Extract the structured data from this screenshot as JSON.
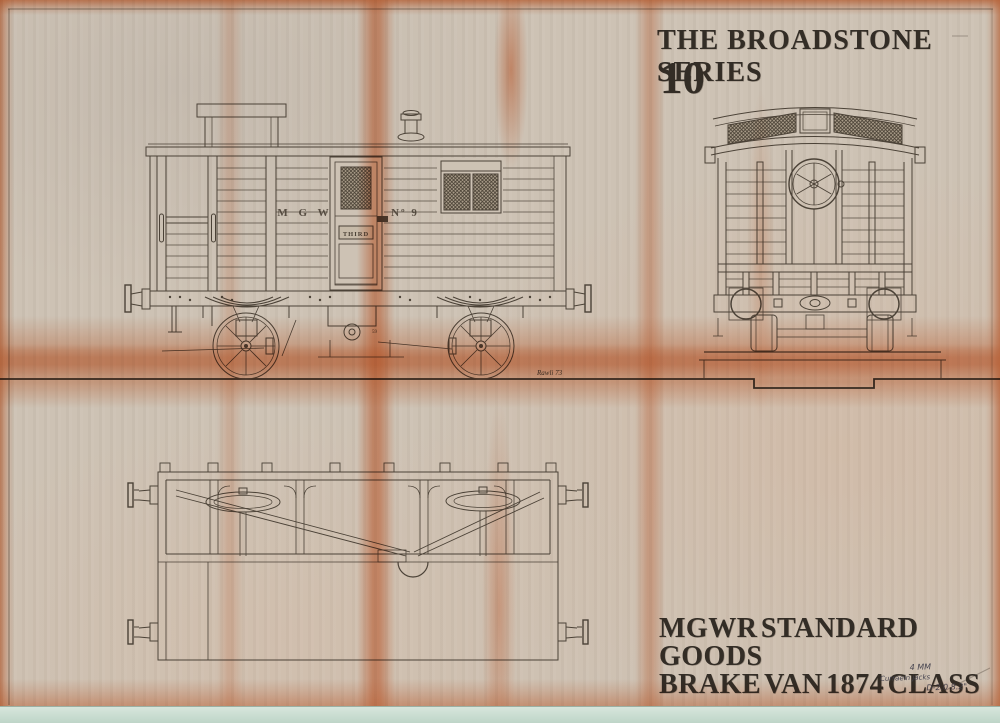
{
  "titles": {
    "series": "THE BROADSTONE SERIES",
    "series_number": "10",
    "class_line1": "MGWR STANDARD GOODS",
    "class_line2": "BRAKE VAN 1874 CLASS"
  },
  "wagon_markings": {
    "owner_initials": "M G W",
    "running_number": "Nº 9",
    "door_class": "THIRD",
    "part_label": "59"
  },
  "handwritten": {
    "scale_note": "4 MM",
    "note": "Curraein jacks",
    "drawing_ref": "D-2.0 8.2\"",
    "signature": "Rawli 73"
  },
  "colors": {
    "paper": "#cdc2b4",
    "ink": "#4b4237",
    "stain_orange": "#e07a45",
    "title_ink": "#332d26",
    "backing_strip_green": "#cfe2d5"
  }
}
